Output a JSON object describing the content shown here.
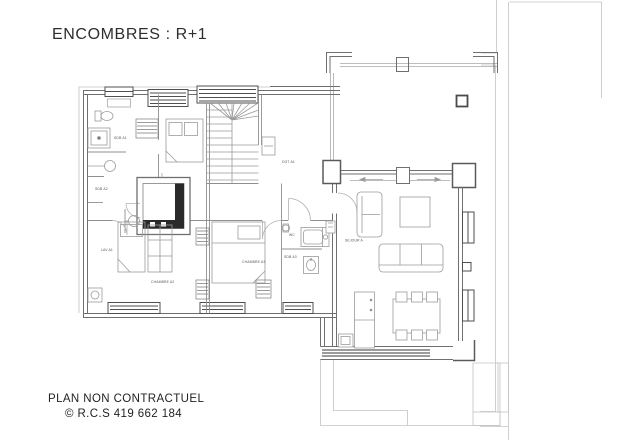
{
  "page": {
    "title": "ENCOMBRES : R+1",
    "footer_line1": "PLAN NON CONTRACTUEL",
    "footer_line2": "© R.C.S 419 662 184"
  },
  "colors": {
    "background": "#ffffff",
    "wall_line": "#6f6f6f",
    "thin_line": "#a8a8a8",
    "faint_line": "#c3c3c3",
    "dark_detail": "#2a2a2a",
    "label_text": "#555555",
    "title_text": "#2e2e2e"
  },
  "plan": {
    "labels": {
      "sdb_a1": "SDB A1",
      "sdb_a2": "SDB A2",
      "lav_a1": "LAV A1",
      "dgt_a1": "DGT A1",
      "chambre_a2": "CHAMBRE A2",
      "chambre_a3": "CHAMBRE A3",
      "wc": "WC",
      "sdb_a3": "SDB A3",
      "sejour_a": "SEJOUR A"
    }
  }
}
